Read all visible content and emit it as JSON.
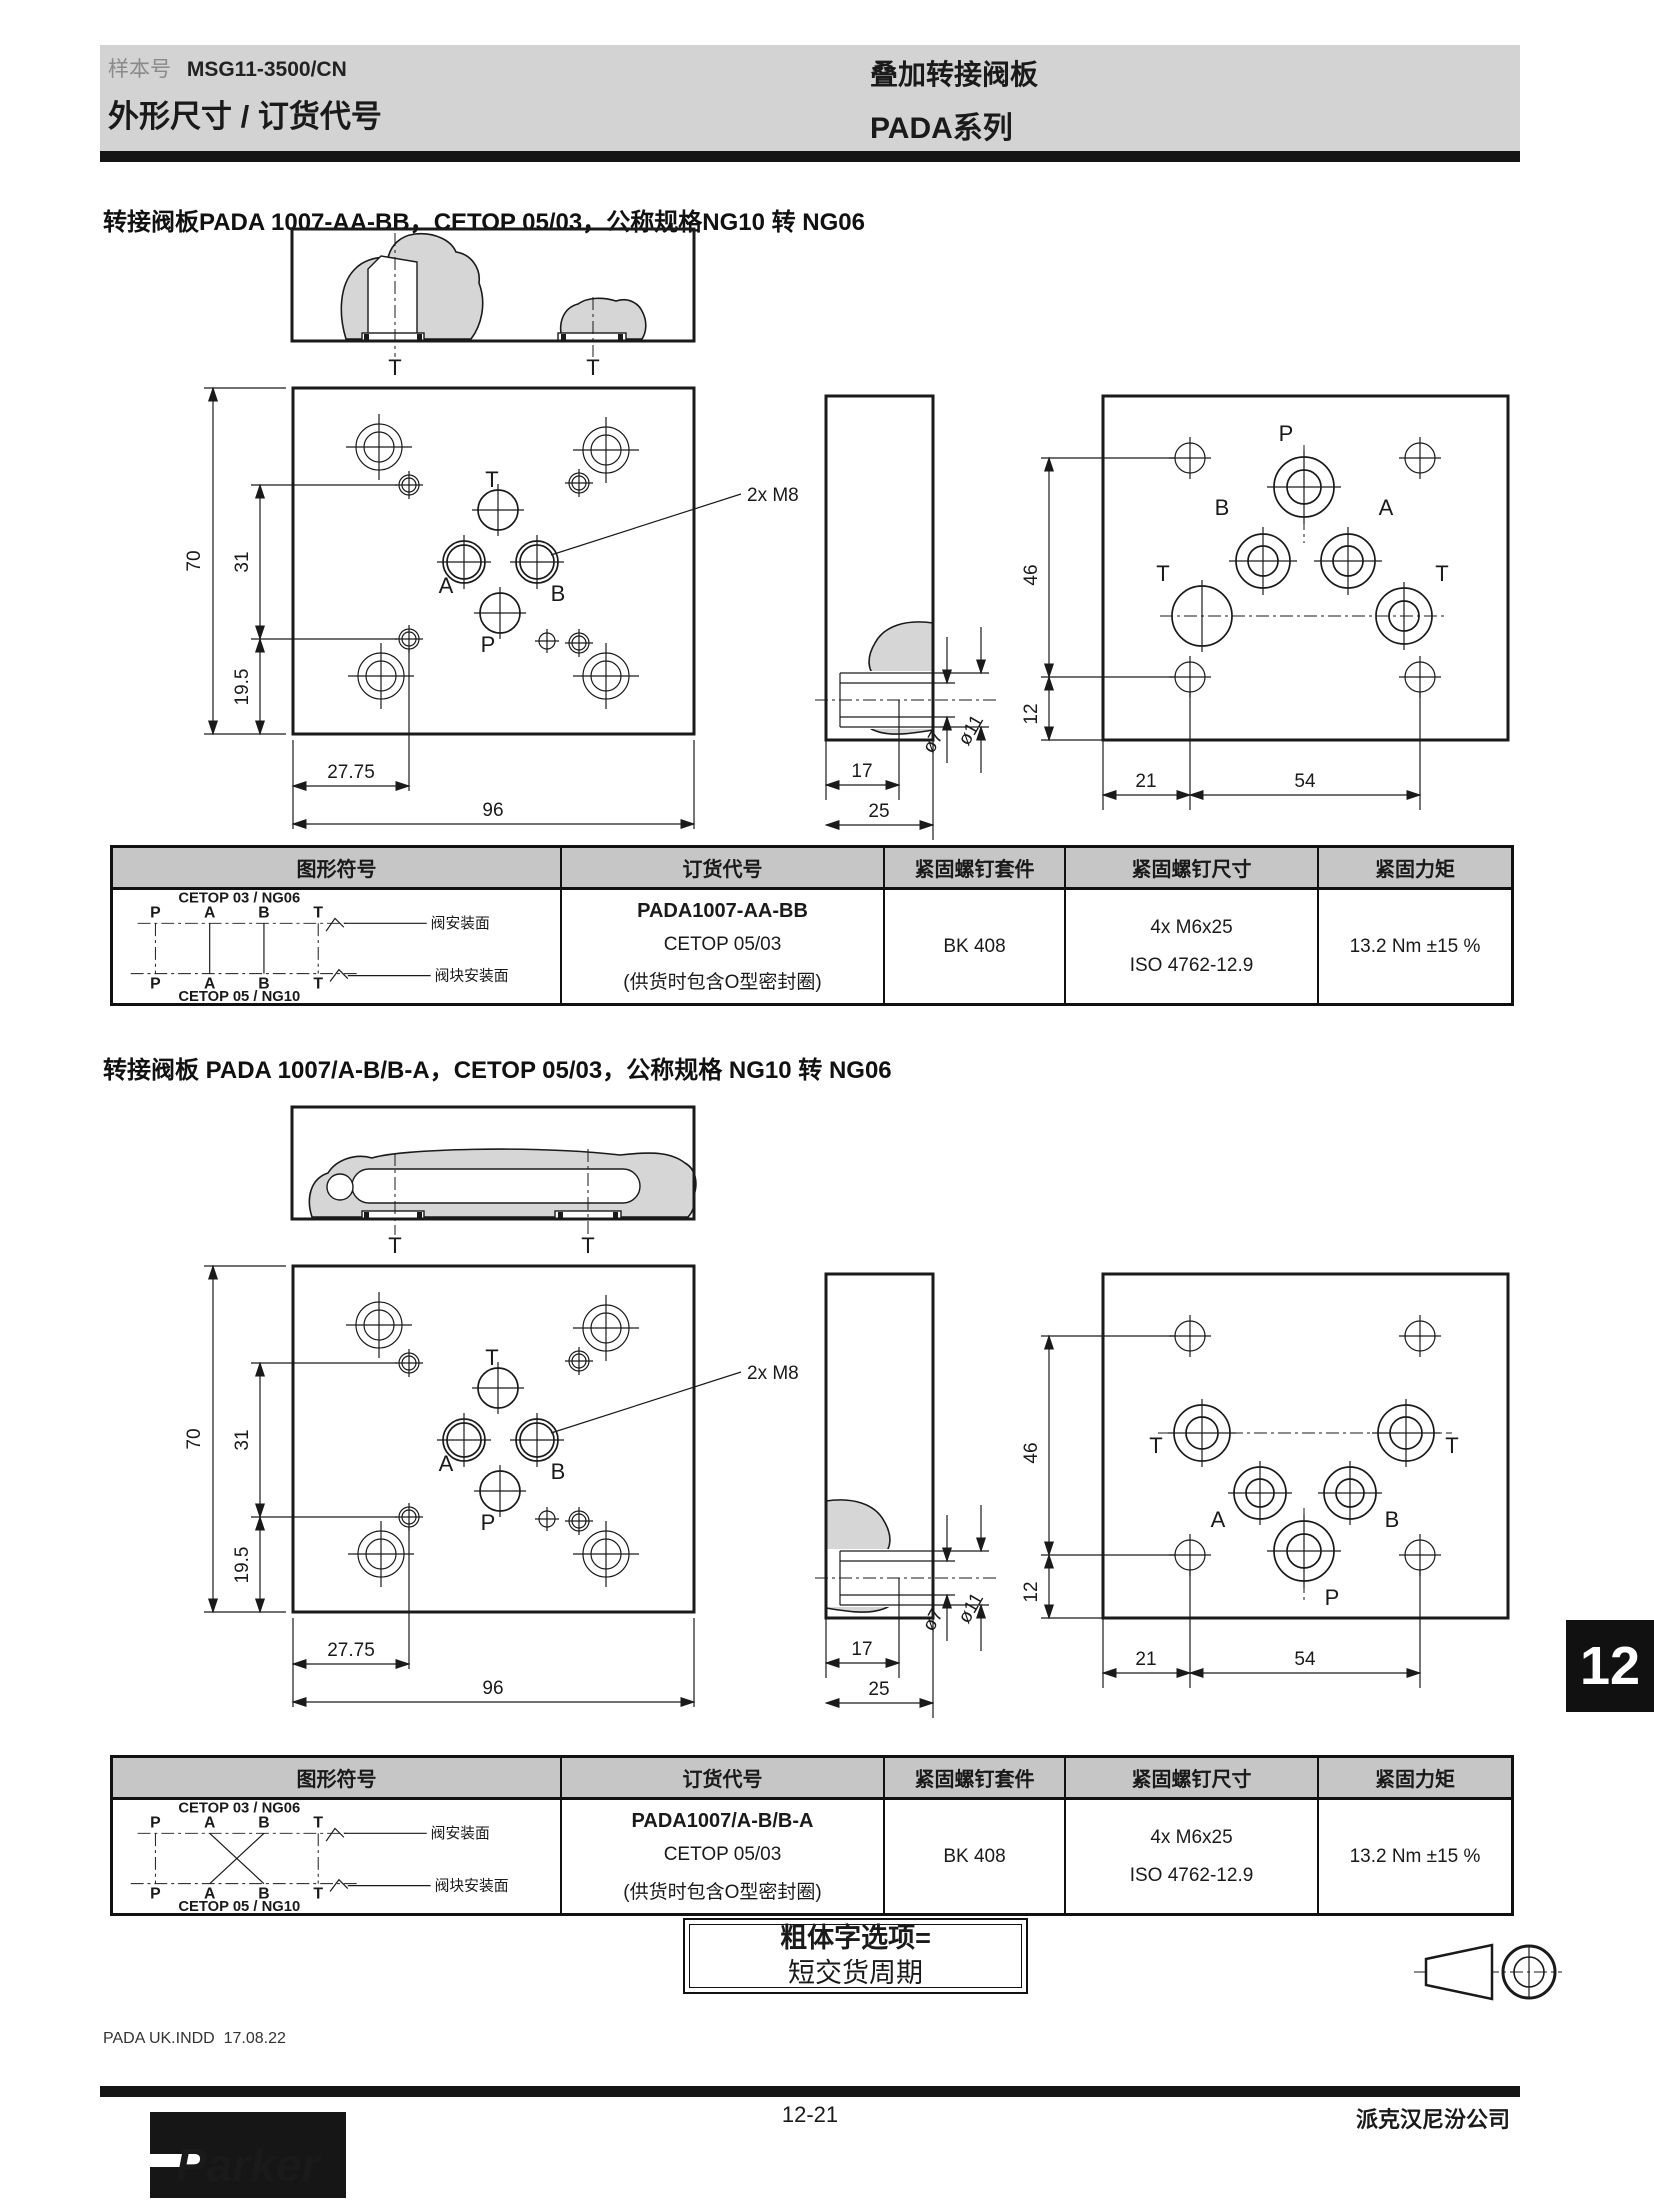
{
  "header": {
    "doc_label": "样本号",
    "doc_number": "MSG11-3500/CN",
    "page_title": "外形尺寸 / 订货代号",
    "product_title": "叠加转接阀板",
    "series_title": "PADA系列"
  },
  "sections": [
    {
      "title": "转接阀板PADA 1007-AA-BB，CETOP 05/03，公称规格NG10 转 NG06"
    },
    {
      "title": "转接阀板 PADA 1007/A-B/B-A，CETOP 05/03，公称规格 NG10 转 NG06"
    }
  ],
  "dims": {
    "height": "70",
    "upper": "31",
    "lower": "19.5",
    "offset": "27.75",
    "width": "96",
    "thread": "2x M8",
    "depth": "17",
    "thickness": "25",
    "dia_small": "ø7",
    "dia_large": "ø11",
    "back_height": "46",
    "back_bottom": "12",
    "back_left": "21",
    "back_span": "54",
    "port_t": "T",
    "port_a": "A",
    "port_b": "B",
    "port_p": "P"
  },
  "table": {
    "headers": [
      "图形符号",
      "订货代号",
      "紧固螺钉套件",
      "紧固螺钉尺寸",
      "紧固力矩"
    ],
    "symbol": {
      "top_standard": "CETOP 03 / NG06",
      "bottom_standard": "CETOP 05 / NG10",
      "ports": [
        "P",
        "A",
        "B",
        "T"
      ],
      "top_surface": "阀安装面",
      "bottom_surface": "阀块安装面"
    },
    "rows": [
      {
        "code": "PADA1007-AA-BB",
        "cetop": "CETOP 05/03",
        "note": "(供货时包含O型密封圈)",
        "kit": "BK 408",
        "screw_size": "4x M6x25",
        "screw_standard": "ISO 4762-12.9",
        "torque": "13.2 Nm ±15 %"
      },
      {
        "code": "PADA1007/A-B/B-A",
        "cetop": "CETOP 05/03",
        "note": "(供货时包含O型密封圈)",
        "kit": "BK 408",
        "screw_size": "4x M6x25",
        "screw_standard": "ISO 4762-12.9",
        "torque": "13.2 Nm ±15 %"
      }
    ]
  },
  "note_box": {
    "line1": "粗体字选项=",
    "line2": "短交货周期"
  },
  "footer": {
    "file_note": "PADA UK.INDD  17.08.22",
    "page_number": "12-21",
    "company": "派克汉尼汾公司",
    "logo_text": "Parker",
    "chapter_tab": "12"
  },
  "colors": {
    "band_gray": "#d3d3d3",
    "table_header_gray": "#c6c6c6",
    "drawing_gray": "#d6d6d6",
    "ink": "#1a1a1a"
  }
}
